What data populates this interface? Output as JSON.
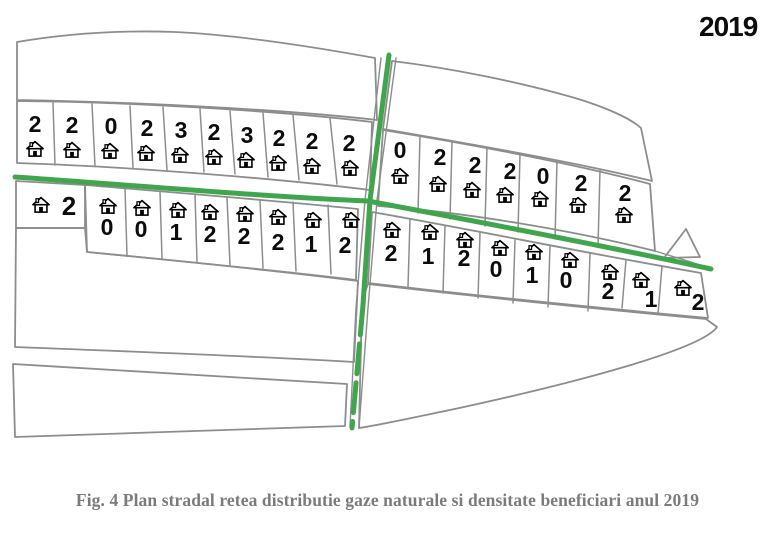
{
  "year_label": "2019",
  "caption": "Fig. 4 Plan stradal retea distributie gaze naturale si densitate beneficiari anul 2019",
  "colors": {
    "road_green": "#3fa64d",
    "outline_gray": "#8d8d8d",
    "caption_gray": "#7b7b7b",
    "number_black": "#0c0c0c"
  },
  "icons": {
    "parcel_marker": "house-icon"
  },
  "map": {
    "roads": {
      "horizontal_main": "gas-pipeline-street-horizontal",
      "vertical_cross": "gas-pipeline-street-vertical"
    }
  },
  "parcel_rows": {
    "upper_left": {
      "counts": [
        2,
        2,
        0,
        2,
        3,
        2,
        3,
        2,
        2,
        2
      ]
    },
    "upper_right": {
      "counts": [
        0,
        2,
        2,
        2,
        0,
        2,
        2
      ]
    },
    "lower_left_wide": {
      "count": 2
    },
    "lower_left": {
      "counts": [
        0,
        0,
        1,
        2,
        2,
        2,
        1,
        2
      ]
    },
    "lower_right": {
      "counts": [
        2,
        1,
        2,
        0,
        1,
        0,
        2,
        1,
        2
      ]
    }
  }
}
